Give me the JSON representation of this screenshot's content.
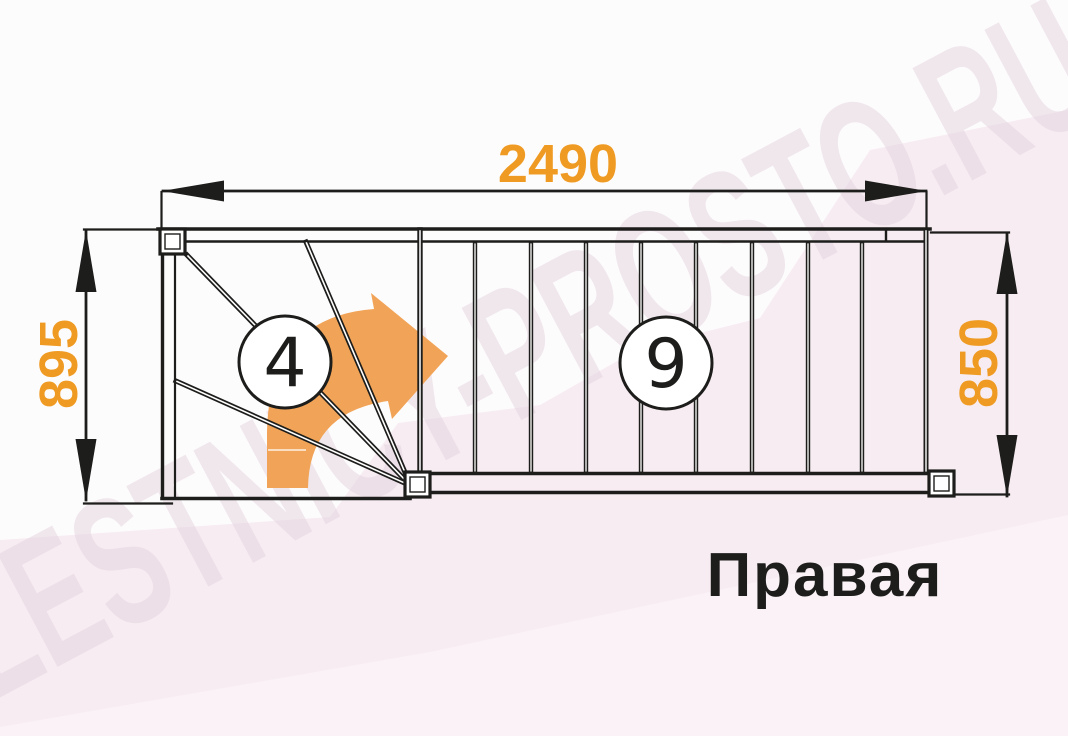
{
  "diagram": {
    "type_label": "Правая",
    "watermark": "LESTNICY-PROSTO.RU",
    "dimensions": {
      "total_length": "2490",
      "left_width": "895",
      "right_width": "850"
    },
    "step_counts": {
      "winder": "4",
      "straight": "9"
    },
    "colors": {
      "dimension_text": "#EF9B23",
      "arrow_fill": "#F1A457",
      "line": "#1D1D1B",
      "label_text": "#1D1D1B",
      "background": "#FDFCFD",
      "background_pink": "#F7ECF2",
      "background_pink_light": "#FAF2F7",
      "watermark": "#E5D3DE"
    }
  }
}
